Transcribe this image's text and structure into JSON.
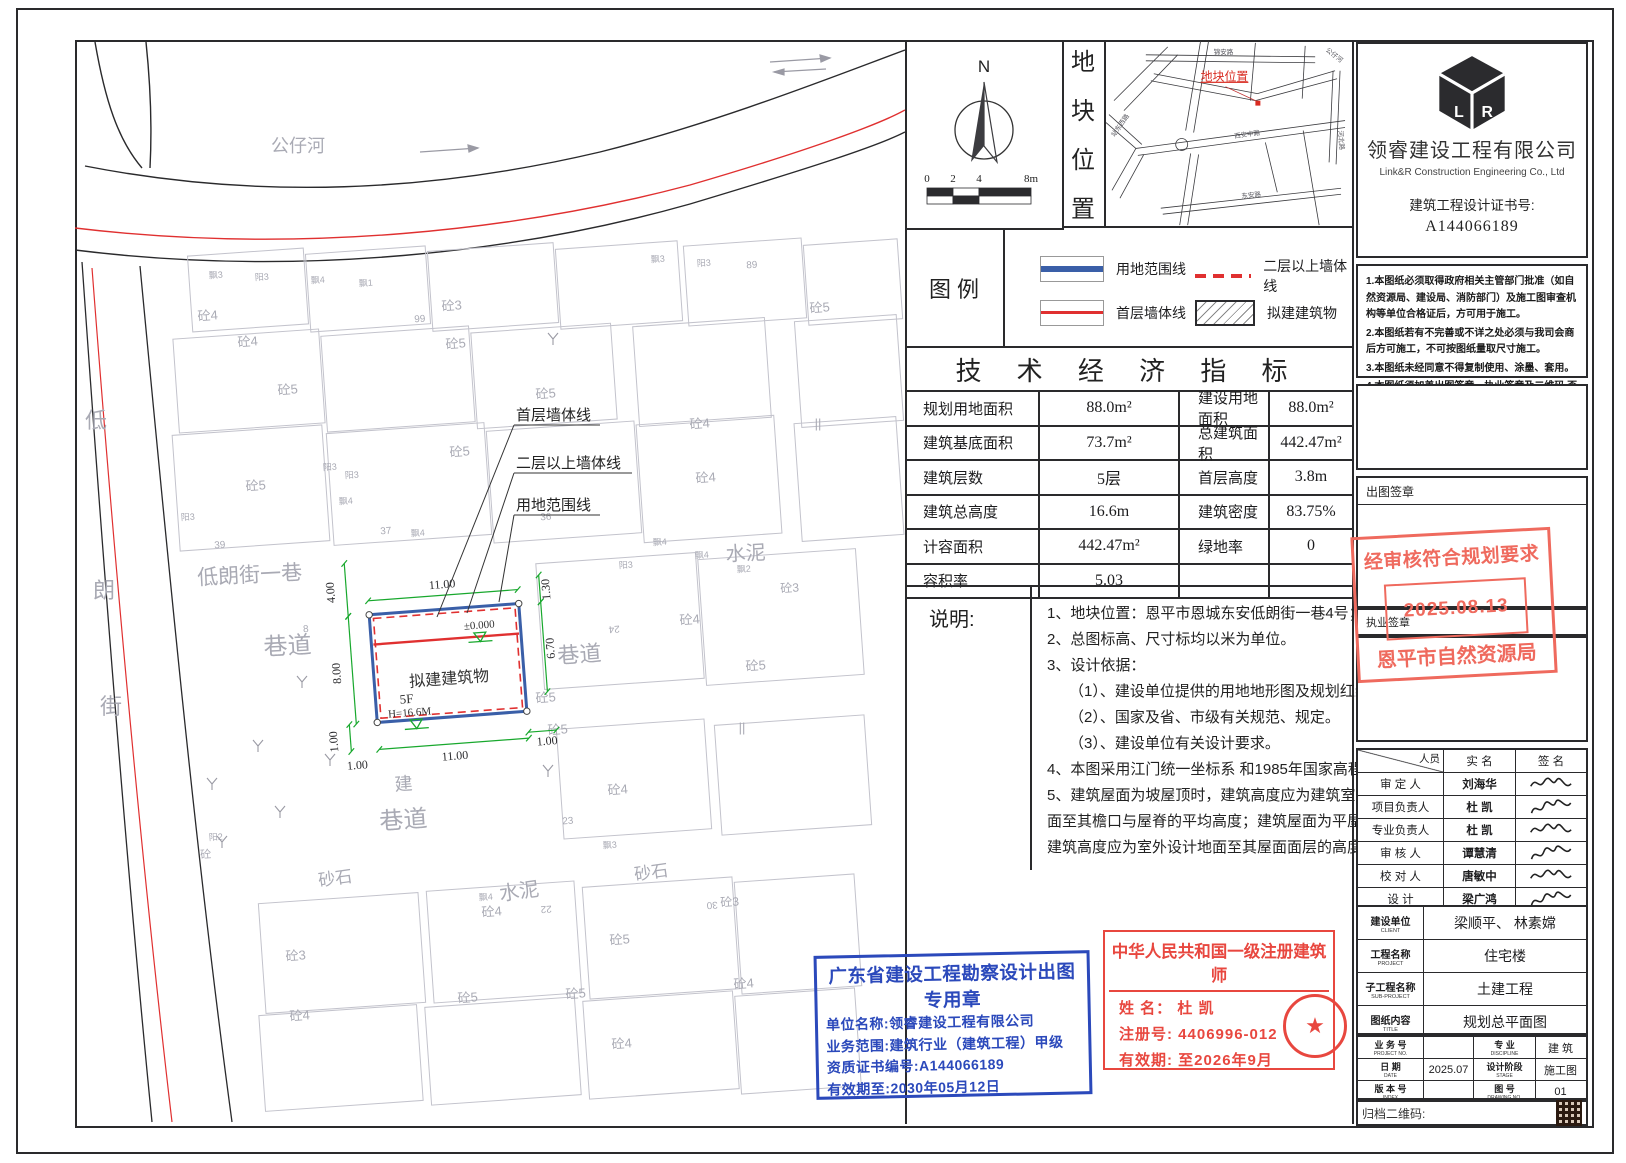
{
  "compass": {
    "north_label": "N",
    "scale_ticks": [
      "0",
      "2",
      "4",
      "8m"
    ]
  },
  "location_panel": {
    "vertical_title": [
      "地",
      "块",
      "位",
      "置"
    ],
    "marker_label": "地块位置",
    "roads": [
      {
        "t": "锦安路",
        "x": 118,
        "y": 13,
        "r": 0
      },
      {
        "t": "公仔河",
        "x": 228,
        "y": 16,
        "r": 38
      },
      {
        "t": "站东西路",
        "x": 16,
        "y": 86,
        "r": -55
      },
      {
        "t": "西安中路",
        "x": 142,
        "y": 96,
        "r": -8
      },
      {
        "t": "东安路",
        "x": 146,
        "y": 157,
        "r": -6
      },
      {
        "t": "河北路",
        "x": 234,
        "y": 100,
        "r": 85
      }
    ]
  },
  "legend": {
    "title": "图  例",
    "items": [
      {
        "label": "用地范围线",
        "style": "blue-solid"
      },
      {
        "label": "首层墙体线",
        "style": "red-solid"
      },
      {
        "label": "二层以上墙体线",
        "style": "red-dashed"
      },
      {
        "label": "拟建建筑物",
        "style": "hatch"
      }
    ]
  },
  "tech": {
    "title": "技 术 经 济 指 标",
    "rows": [
      [
        "规划用地面积",
        "88.0m²",
        "建设用地面积",
        "88.0m²"
      ],
      [
        "建筑基底面积",
        "73.7m²",
        "总建筑面积",
        "442.47m²"
      ],
      [
        "建筑层数",
        "5层",
        "首层高度",
        "3.8m"
      ],
      [
        "建筑总高度",
        "16.6m",
        "建筑密度",
        "83.75%"
      ],
      [
        "计容面积",
        "442.47m²",
        "绿地率",
        "0"
      ],
      [
        "容积率",
        "5.03",
        "",
        ""
      ]
    ]
  },
  "shuoming": {
    "label": "说明:",
    "lines": [
      "1、地块位置：恩平市恩城东安低朗街一巷4号；",
      "2、总图标高、尺寸标均以米为单位。",
      "3、设计依据：",
      "（1）、建设单位提供的用地地形图及规划红线图。",
      "（2）、国家及省、市级有关规范、规定。",
      "（3）、建设单位有关设计要求。",
      "4、本图采用江门统一坐标系 和1985年国家高程基准；",
      "5、建筑屋面为坡屋顶时，建筑高度应为建筑室外设计地",
      "面至其檐口与屋脊的平均高度；建筑屋面为平屋顶时，",
      "建筑高度应为室外设计地面至其屋面面层的高度；"
    ]
  },
  "plan": {
    "building": {
      "name": "拟建建筑物",
      "floors": "5F",
      "height": "H=16.6M",
      "level": "±0.000"
    },
    "callouts": [
      {
        "t": "首层墙体线",
        "x": 516,
        "y": 420,
        "w": 84,
        "lx": 437,
        "ly": 617
      },
      {
        "t": "二层以上墙体线",
        "x": 516,
        "y": 468,
        "w": 116,
        "lx": 467,
        "ly": 613
      },
      {
        "t": "用地范围线",
        "x": 516,
        "y": 510,
        "w": 84,
        "lx": 499,
        "ly": 602
      }
    ],
    "dim_lines": [
      [
        373,
        595,
        523,
        595
      ],
      [
        352,
        556,
        352,
        609
      ],
      [
        352,
        609,
        352,
        717
      ],
      [
        345,
        717,
        345,
        744
      ],
      [
        545,
        582,
        545,
        609
      ],
      [
        545,
        609,
        545,
        699
      ],
      [
        373,
        744,
        523,
        744
      ],
      [
        523,
        738,
        551,
        738
      ]
    ],
    "dim_labels": [
      {
        "t": "11.00",
        "x": 448,
        "y": 588,
        "r": 0
      },
      {
        "t": "4.00",
        "x": 340,
        "y": 584,
        "r": -90
      },
      {
        "t": "8.00",
        "x": 340,
        "y": 665,
        "r": -90
      },
      {
        "t": "1.00",
        "x": 332,
        "y": 733,
        "r": -90
      },
      {
        "t": "1.30",
        "x": 555,
        "y": 597,
        "r": -90
      },
      {
        "t": "6.70",
        "x": 555,
        "y": 656,
        "r": -90
      },
      {
        "t": "11.00",
        "x": 448,
        "y": 760,
        "r": 0
      },
      {
        "t": "1.00",
        "x": 350,
        "y": 762,
        "r": 0
      },
      {
        "t": "1.00",
        "x": 541,
        "y": 752,
        "r": 0
      }
    ],
    "labels": [
      [
        "公仔河",
        298,
        152,
        18,
        0
      ],
      [
        "低",
        96,
        428,
        22,
        0
      ],
      [
        "朗",
        104,
        598,
        22,
        0
      ],
      [
        "街",
        111,
        714,
        22,
        0
      ],
      [
        "低朗街一巷",
        250,
        582,
        21,
        -3
      ],
      [
        "水泥",
        746,
        560,
        20,
        -3
      ],
      [
        "水泥",
        520,
        898,
        20,
        -8
      ],
      [
        "砂石",
        336,
        884,
        17,
        -8
      ],
      [
        "砂石",
        652,
        878,
        17,
        -8
      ],
      [
        "巷道",
        288,
        654,
        24,
        -3
      ],
      [
        "巷道",
        580,
        662,
        22,
        -4
      ],
      [
        "建",
        404,
        790,
        18,
        -4
      ],
      [
        "巷道",
        404,
        828,
        24,
        -4
      ],
      [
        "飘3",
        216,
        278,
        9,
        -4
      ],
      [
        "阳3",
        262,
        280,
        9,
        -4
      ],
      [
        "飘4",
        318,
        283,
        9,
        -4
      ],
      [
        "飘1",
        366,
        286,
        9,
        -4
      ],
      [
        "飘3",
        658,
        262,
        9,
        -4
      ],
      [
        "阳3",
        704,
        266,
        9,
        -4
      ],
      [
        "89",
        752,
        268,
        10,
        -4
      ],
      [
        "砼4",
        208,
        320,
        13,
        -4
      ],
      [
        "砼3",
        452,
        310,
        13,
        -4
      ],
      [
        "砼5",
        820,
        312,
        13,
        -4
      ],
      [
        "99",
        420,
        322,
        10,
        -4
      ],
      [
        "砼4",
        248,
        346,
        13,
        -4
      ],
      [
        "砼5",
        456,
        348,
        13,
        -4
      ],
      [
        "砼5",
        288,
        394,
        13,
        -4
      ],
      [
        "砼5",
        546,
        398,
        13,
        -4
      ],
      [
        "砼4",
        700,
        428,
        13,
        -4
      ],
      [
        "||",
        818,
        428,
        13,
        0
      ],
      [
        "砼5",
        256,
        490,
        13,
        -4
      ],
      [
        "砼5",
        460,
        456,
        13,
        -4
      ],
      [
        "砼4",
        706,
        482,
        13,
        -4
      ],
      [
        "37",
        386,
        534,
        10,
        -4
      ],
      [
        "39",
        220,
        548,
        10,
        -4
      ],
      [
        "36",
        546,
        520,
        10,
        -4
      ],
      [
        "飘4",
        418,
        536,
        9,
        -4
      ],
      [
        "飘4",
        660,
        545,
        9,
        -4
      ],
      [
        "阳3",
        330,
        470,
        9,
        -4
      ],
      [
        "阳3",
        188,
        520,
        9,
        -4
      ],
      [
        "阳3",
        626,
        568,
        9,
        -4
      ],
      [
        "飘4",
        702,
        558,
        9,
        -4
      ],
      [
        "飘2",
        744,
        572,
        9,
        -4
      ],
      [
        "24",
        614,
        626,
        10,
        176
      ],
      [
        "8",
        306,
        632,
        10,
        -4
      ],
      [
        "砼4",
        690,
        624,
        13,
        -4
      ],
      [
        "砼5",
        756,
        670,
        13,
        -4
      ],
      [
        "砼3",
        790,
        592,
        12,
        -4
      ],
      [
        "阳2",
        216,
        840,
        9,
        -4
      ],
      [
        "砼",
        206,
        858,
        11,
        -4
      ],
      [
        "砼5",
        546,
        702,
        13,
        -4
      ],
      [
        "||",
        742,
        732,
        13,
        0
      ],
      [
        "砼5",
        558,
        734,
        13,
        -4
      ],
      [
        "砼4",
        618,
        794,
        13,
        -4
      ],
      [
        "23",
        568,
        824,
        10,
        -4
      ],
      [
        "飘3",
        610,
        848,
        9,
        -4
      ],
      [
        "砼5",
        620,
        944,
        13,
        -4
      ],
      [
        "砼4",
        492,
        916,
        13,
        -4
      ],
      [
        "飘4",
        486,
        900,
        9,
        -4
      ],
      [
        "30",
        712,
        902,
        10,
        176
      ],
      [
        "22",
        546,
        906,
        10,
        176
      ],
      [
        "砼3",
        730,
        906,
        12,
        -4
      ],
      [
        "砼3",
        296,
        960,
        13,
        -4
      ],
      [
        "砼4",
        300,
        1020,
        13,
        -4
      ],
      [
        "砼5",
        468,
        1002,
        13,
        -4
      ],
      [
        "砼5",
        576,
        998,
        13,
        -4
      ],
      [
        "砼4",
        622,
        1048,
        13,
        -4
      ],
      [
        "砼4",
        744,
        988,
        13,
        -4
      ],
      [
        "飘4",
        346,
        504,
        9,
        -4
      ],
      [
        "阳3",
        352,
        478,
        9,
        -4
      ]
    ],
    "parcels": [
      [
        190,
        252,
        116,
        76
      ],
      [
        308,
        250,
        120,
        78
      ],
      [
        430,
        247,
        126,
        80
      ],
      [
        558,
        245,
        122,
        80
      ],
      [
        686,
        242,
        118,
        80
      ],
      [
        806,
        242,
        94,
        80
      ],
      [
        176,
        334,
        146,
        94
      ],
      [
        324,
        331,
        148,
        96
      ],
      [
        474,
        328,
        140,
        96
      ],
      [
        636,
        322,
        132,
        100
      ],
      [
        798,
        318,
        102,
        106
      ],
      [
        176,
        430,
        150,
        116
      ],
      [
        330,
        428,
        158,
        112
      ],
      [
        490,
        426,
        148,
        112
      ],
      [
        640,
        420,
        138,
        118
      ],
      [
        798,
        420,
        102,
        118
      ],
      [
        540,
        558,
        160,
        126
      ],
      [
        702,
        554,
        158,
        126
      ],
      [
        560,
        724,
        148,
        110
      ],
      [
        718,
        720,
        150,
        110
      ],
      [
        430,
        886,
        148,
        112
      ],
      [
        586,
        882,
        150,
        112
      ],
      [
        738,
        878,
        120,
        112
      ],
      [
        262,
        898,
        160,
        110
      ],
      [
        262,
        1010,
        158,
        96
      ],
      [
        428,
        1002,
        150,
        98
      ],
      [
        586,
        996,
        150,
        98
      ],
      [
        738,
        992,
        120,
        98
      ]
    ],
    "trees": [
      [
        258,
        752
      ],
      [
        212,
        790
      ],
      [
        280,
        818
      ],
      [
        222,
        848
      ],
      [
        330,
        766
      ],
      [
        553,
        345
      ],
      [
        302,
        688
      ],
      [
        548,
        777
      ]
    ]
  },
  "company": {
    "logo": "LR",
    "name": "领睿建设工程有限公司",
    "en": "Link&R Construction Engineering Co., Ltd",
    "cert_label": "建筑工程设计证书号:",
    "cert_no": "A144066189"
  },
  "notes4": [
    "1.本图纸必须取得政府相关主管部门批准（如自然资源局、建设局、消防部门）及施工图审查机构等单位合格证后，方可用于施工。",
    "2.本图纸若有不完善或不详之处必须与我司会商后方可施工，不可按图纸量取尺寸施工。",
    "3.本图纸未经同意不得复制使用、涂墨、套用。",
    "4.本图纸须加盖出图签章、执业签章及二维码,否则一律无效。"
  ],
  "seal_labels": {
    "chutu": "出图签章",
    "zhiye": "执业签章"
  },
  "plan_stamp": {
    "line1": "经审核符合规划要求",
    "date": "2025.08.13",
    "line2": "恩平市自然资源局"
  },
  "sign_table": {
    "header": {
      "corner": "人员",
      "name": "实  名",
      "sig": "签  名"
    },
    "rows": [
      {
        "role": "审 定 人",
        "name": "刘海华"
      },
      {
        "role": "项目负责人",
        "name": "杜  凯"
      },
      {
        "role": "专业负责人",
        "name": "杜  凯"
      },
      {
        "role": "审 核 人",
        "name": "谭慧清"
      },
      {
        "role": "校 对 人",
        "name": "唐敏中"
      },
      {
        "role": "设   计",
        "name": "梁广鸿"
      }
    ]
  },
  "title_block": {
    "rows": [
      {
        "zh": "建设单位",
        "en": "CLIENT",
        "v": "梁顺平、 林素嫦"
      },
      {
        "zh": "工程名称",
        "en": "PROJECT",
        "v": "住宅楼"
      },
      {
        "zh": "子工程名称",
        "en": "SUB-PROJECT",
        "v": "土建工程"
      },
      {
        "zh": "图纸内容",
        "en": "TITLE",
        "v": "规划总平面图"
      }
    ],
    "grid": [
      {
        "zh": "业 务 号",
        "en": "PROJECT NO.",
        "v": "",
        "zh2": "专  业",
        "en2": "DISCIPLINE",
        "v2": "建 筑"
      },
      {
        "zh": "日  期",
        "en": "DATE",
        "v": "2025.07",
        "zh2": "设计阶段",
        "en2": "STAGE",
        "v2": "施工图"
      },
      {
        "zh": "版 本 号",
        "en": "INDEX",
        "v": "",
        "zh2": "图  号",
        "en2": "DRAWING NO.",
        "v2": "01"
      }
    ],
    "qr_label": "归档二维码:"
  },
  "blue_stamp": {
    "title": "广东省建设工程勘察设计出图专用章",
    "lines": [
      "单位名称:领睿建设工程有限公司",
      "业务范围:建筑行业（建筑工程）甲级",
      "资质证书编号:A144066189",
      "有效期至:2030年05月12日"
    ]
  },
  "arch_stamp": {
    "title": "中华人民共和国一级注册建筑师",
    "lines": [
      "姓  名：  杜  凯",
      "注册号: 4406996-012",
      "有效期: 至2026年9月"
    ]
  }
}
